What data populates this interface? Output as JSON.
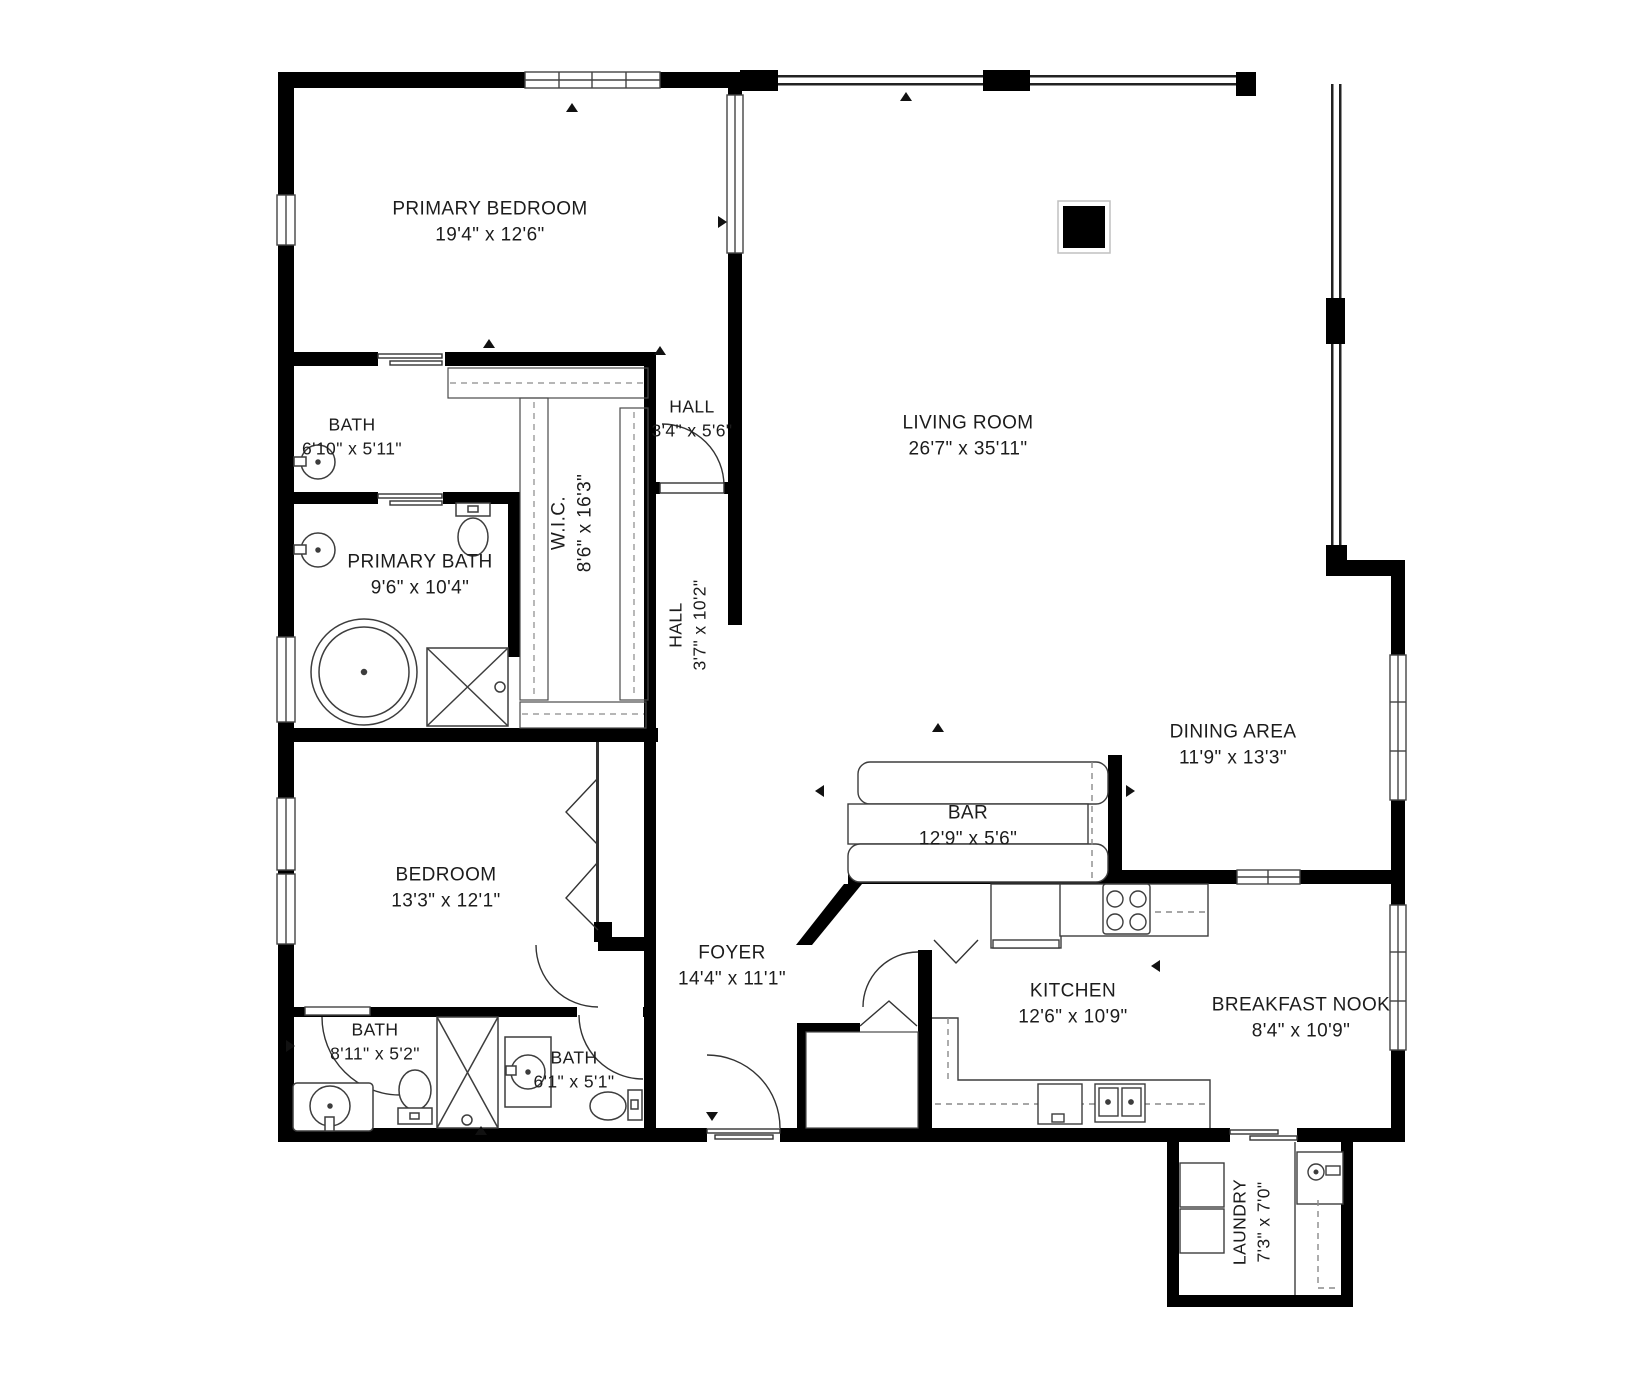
{
  "plan": {
    "type": "residential-floor-plan",
    "colors": {
      "wall": "#000000",
      "fixture_line": "#3d3d3d",
      "dashed_line": "#8a8a8a",
      "background": "#ffffff",
      "text": "#1c1c1c"
    },
    "rooms": [
      {
        "id": "primary-bedroom",
        "name": "PRIMARY BEDROOM",
        "dims": "19'4\" x 12'6\""
      },
      {
        "id": "bath-upper",
        "name": "BATH",
        "dims": "6'10\" x 5'11\""
      },
      {
        "id": "hall-small",
        "name": "HALL",
        "dims": "3'4\" x 5'6\""
      },
      {
        "id": "living-room",
        "name": "LIVING ROOM",
        "dims": "26'7\" x 35'11\""
      },
      {
        "id": "primary-bath",
        "name": "PRIMARY BATH",
        "dims": "9'6\" x 10'4\""
      },
      {
        "id": "walk-in-closet",
        "name": "W.I.C.",
        "dims": "8'6\" x 16'3\""
      },
      {
        "id": "hall-vertical",
        "name": "HALL",
        "dims": "3'7\" x 10'2\""
      },
      {
        "id": "dining-area",
        "name": "DINING AREA",
        "dims": "11'9\" x 13'3\""
      },
      {
        "id": "bar",
        "name": "BAR",
        "dims": "12'9\" x 5'6\""
      },
      {
        "id": "bedroom",
        "name": "BEDROOM",
        "dims": "13'3\" x 12'1\""
      },
      {
        "id": "foyer",
        "name": "FOYER",
        "dims": "14'4\" x 11'1\""
      },
      {
        "id": "kitchen",
        "name": "KITCHEN",
        "dims": "12'6\" x 10'9\""
      },
      {
        "id": "breakfast-nook",
        "name": "BREAKFAST NOOK",
        "dims": "8'4\" x 10'9\""
      },
      {
        "id": "bath-left",
        "name": "BATH",
        "dims": "8'11\" x 5'2\""
      },
      {
        "id": "bath-center",
        "name": "BATH",
        "dims": "6'1\" x 5'1\""
      },
      {
        "id": "laundry",
        "name": "LAUNDRY",
        "dims": "7'3\" x 7'0\""
      }
    ],
    "fixtures": [
      "bathtub",
      "shower",
      "toilet",
      "round-sink",
      "pedestal-sink",
      "kitchen-stove",
      "refrigerator",
      "kitchen-sink",
      "dishwasher",
      "washer",
      "dryer",
      "laundry-sink",
      "bar-counter",
      "column",
      "closet-shelves",
      "bifold-door",
      "hinged-door",
      "sliding-door",
      "window"
    ]
  }
}
